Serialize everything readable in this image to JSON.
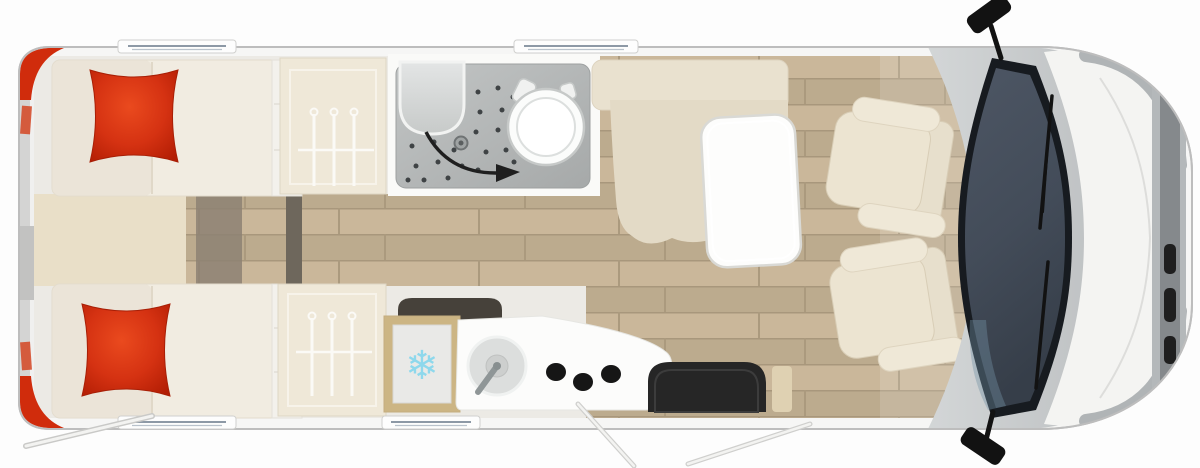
{
  "icons": {
    "snowflake": "❄",
    "names": [
      "snowflake-icon",
      "hanger-icon",
      "door-swing-arrow-icon",
      "wiper-icon",
      "side-mirror-icon",
      "burner-icon",
      "sink-icon",
      "toilet-icon",
      "shower-drain-icon"
    ]
  },
  "counts": {
    "beds": 2,
    "pillows": 2,
    "wardrobes": 2,
    "hangers_per_wardrobe": 3,
    "burners": 3,
    "cab_seats": 2,
    "side_mirrors": 2,
    "windows_top": 2,
    "windows_bottom": 2
  },
  "colors": {
    "body_white": "#f6f6f5",
    "body_outline": "#bdbdbd",
    "rear_band": "#d4d4d3",
    "interior_bg": "#eceae5",
    "accent_red": "#d02c0c",
    "wood": "#c4b295",
    "beige_platform": "#e9dfc8",
    "cream_cabinet": "#efe8d8",
    "bench_cream": "#e3dac6",
    "table_white": "#fdfdfc",
    "shower_gray": "#b2b5b5",
    "fixture_white": "#fbfcfb",
    "counter_white": "#fcfcfb",
    "fridge_frame": "#ccb584",
    "fridge_inner": "#e9e9e7",
    "snowflake_blue": "#8ed8ec",
    "burner_black": "#161616",
    "step_black": "#262626",
    "dash_gray": "#c6c9ca",
    "windshield_frame": "#171b20",
    "hood_white": "#f4f4f2",
    "grille_gray": "#85898c",
    "mirror_black": "#121212",
    "seat_cream": "#ece4d1",
    "arrow_black": "#1f1f1f",
    "window_line": "#8d99a6"
  }
}
